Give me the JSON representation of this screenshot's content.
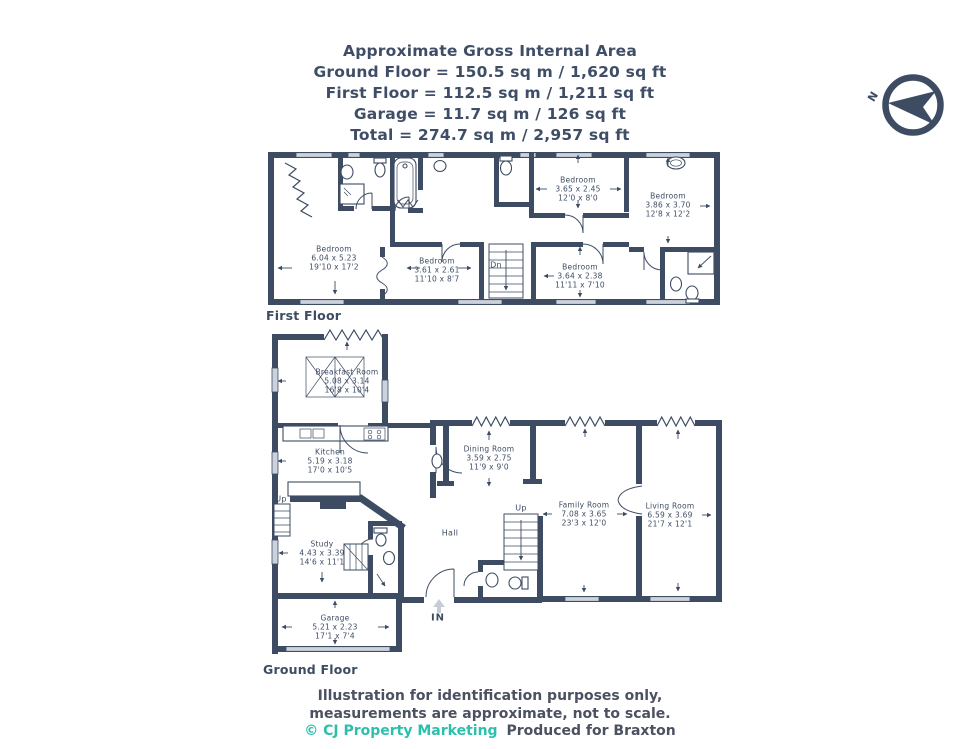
{
  "header": {
    "title": "Approximate Gross Internal Area",
    "lines": [
      "Ground Floor = 150.5 sq m / 1,620 sq ft",
      "First Floor = 112.5 sq m / 1,211 sq ft",
      "Garage = 11.7 sq m / 126 sq ft",
      "Total = 274.7 sq m / 2,957 sq ft"
    ]
  },
  "compass": {
    "north_label": "N"
  },
  "first_floor": {
    "floor_label": "First Floor",
    "stairs_label": "Dn",
    "rooms": [
      {
        "name": "Bedroom",
        "dims_m": "6.04 x 5.23",
        "dims_ft": "19'10 x 17'2"
      },
      {
        "name": "Bedroom",
        "dims_m": "3.61 x 2.61",
        "dims_ft": "11'10 x 8'7"
      },
      {
        "name": "Bedroom",
        "dims_m": "3.65 x 2.45",
        "dims_ft": "12'0 x 8'0"
      },
      {
        "name": "Bedroom",
        "dims_m": "3.86 x 3.70",
        "dims_ft": "12'8 x 12'2"
      },
      {
        "name": "Bedroom",
        "dims_m": "3.64 x 2.38",
        "dims_ft": "11'11 x 7'10"
      }
    ]
  },
  "ground_floor": {
    "floor_label": "Ground Floor",
    "hall_label": "Hall",
    "entrance_label": "IN",
    "stairs_up_label": "Up",
    "stairs_up_label_2": "Up",
    "rooms": [
      {
        "name": "Breakfast Room",
        "dims_m": "5.08 x 3.14",
        "dims_ft": "16'8 x 10'4"
      },
      {
        "name": "Kitchen",
        "dims_m": "5.19 x 3.18",
        "dims_ft": "17'0 x 10'5"
      },
      {
        "name": "Dining Room",
        "dims_m": "3.59 x 2.75",
        "dims_ft": "11'9 x 9'0"
      },
      {
        "name": "Family Room",
        "dims_m": "7.08 x 3.65",
        "dims_ft": "23'3 x 12'0"
      },
      {
        "name": "Living Room",
        "dims_m": "6.59 x 3.69",
        "dims_ft": "21'7 x 12'1"
      },
      {
        "name": "Study",
        "dims_m": "4.43 x 3.39",
        "dims_ft": "14'6 x 11'1"
      },
      {
        "name": "Garage",
        "dims_m": "5.21 x 2.23",
        "dims_ft": "17'1 x 7'4"
      }
    ]
  },
  "footer": {
    "line1": "Illustration for identification purposes only,",
    "line2": "measurements are approximate, not to scale.",
    "copyright": "© CJ Property Marketing",
    "produced": "Produced for Braxton"
  },
  "colors": {
    "wall": "#3d4c63",
    "accent": "#2cc0ac",
    "window": "#ccd2dc"
  }
}
